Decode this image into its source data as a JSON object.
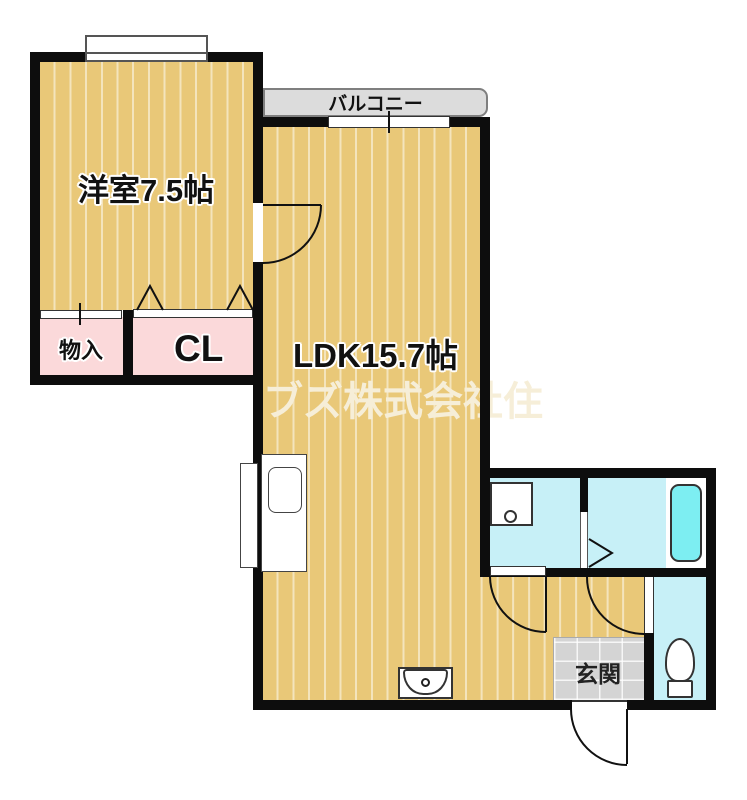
{
  "labels": {
    "balcony": "バルコニー",
    "western_room": "洋室7.5帖",
    "ldk": "LDK15.7帖",
    "storage": "物入",
    "closet": "CL",
    "entrance": "玄関",
    "watermark": "ブズ株式会社住"
  },
  "colors": {
    "wood": "#e9c878",
    "wood_stripe": "rgba(255,255,255,0.5)",
    "pink": "#fbd9da",
    "sanitary": "#c7f0f7",
    "bathtub": "#7deef2",
    "balcony": "#dcdcdc",
    "genkan": "#d4d4d4",
    "wall": "#0d0d0d",
    "watermark": "#f6eed8"
  }
}
